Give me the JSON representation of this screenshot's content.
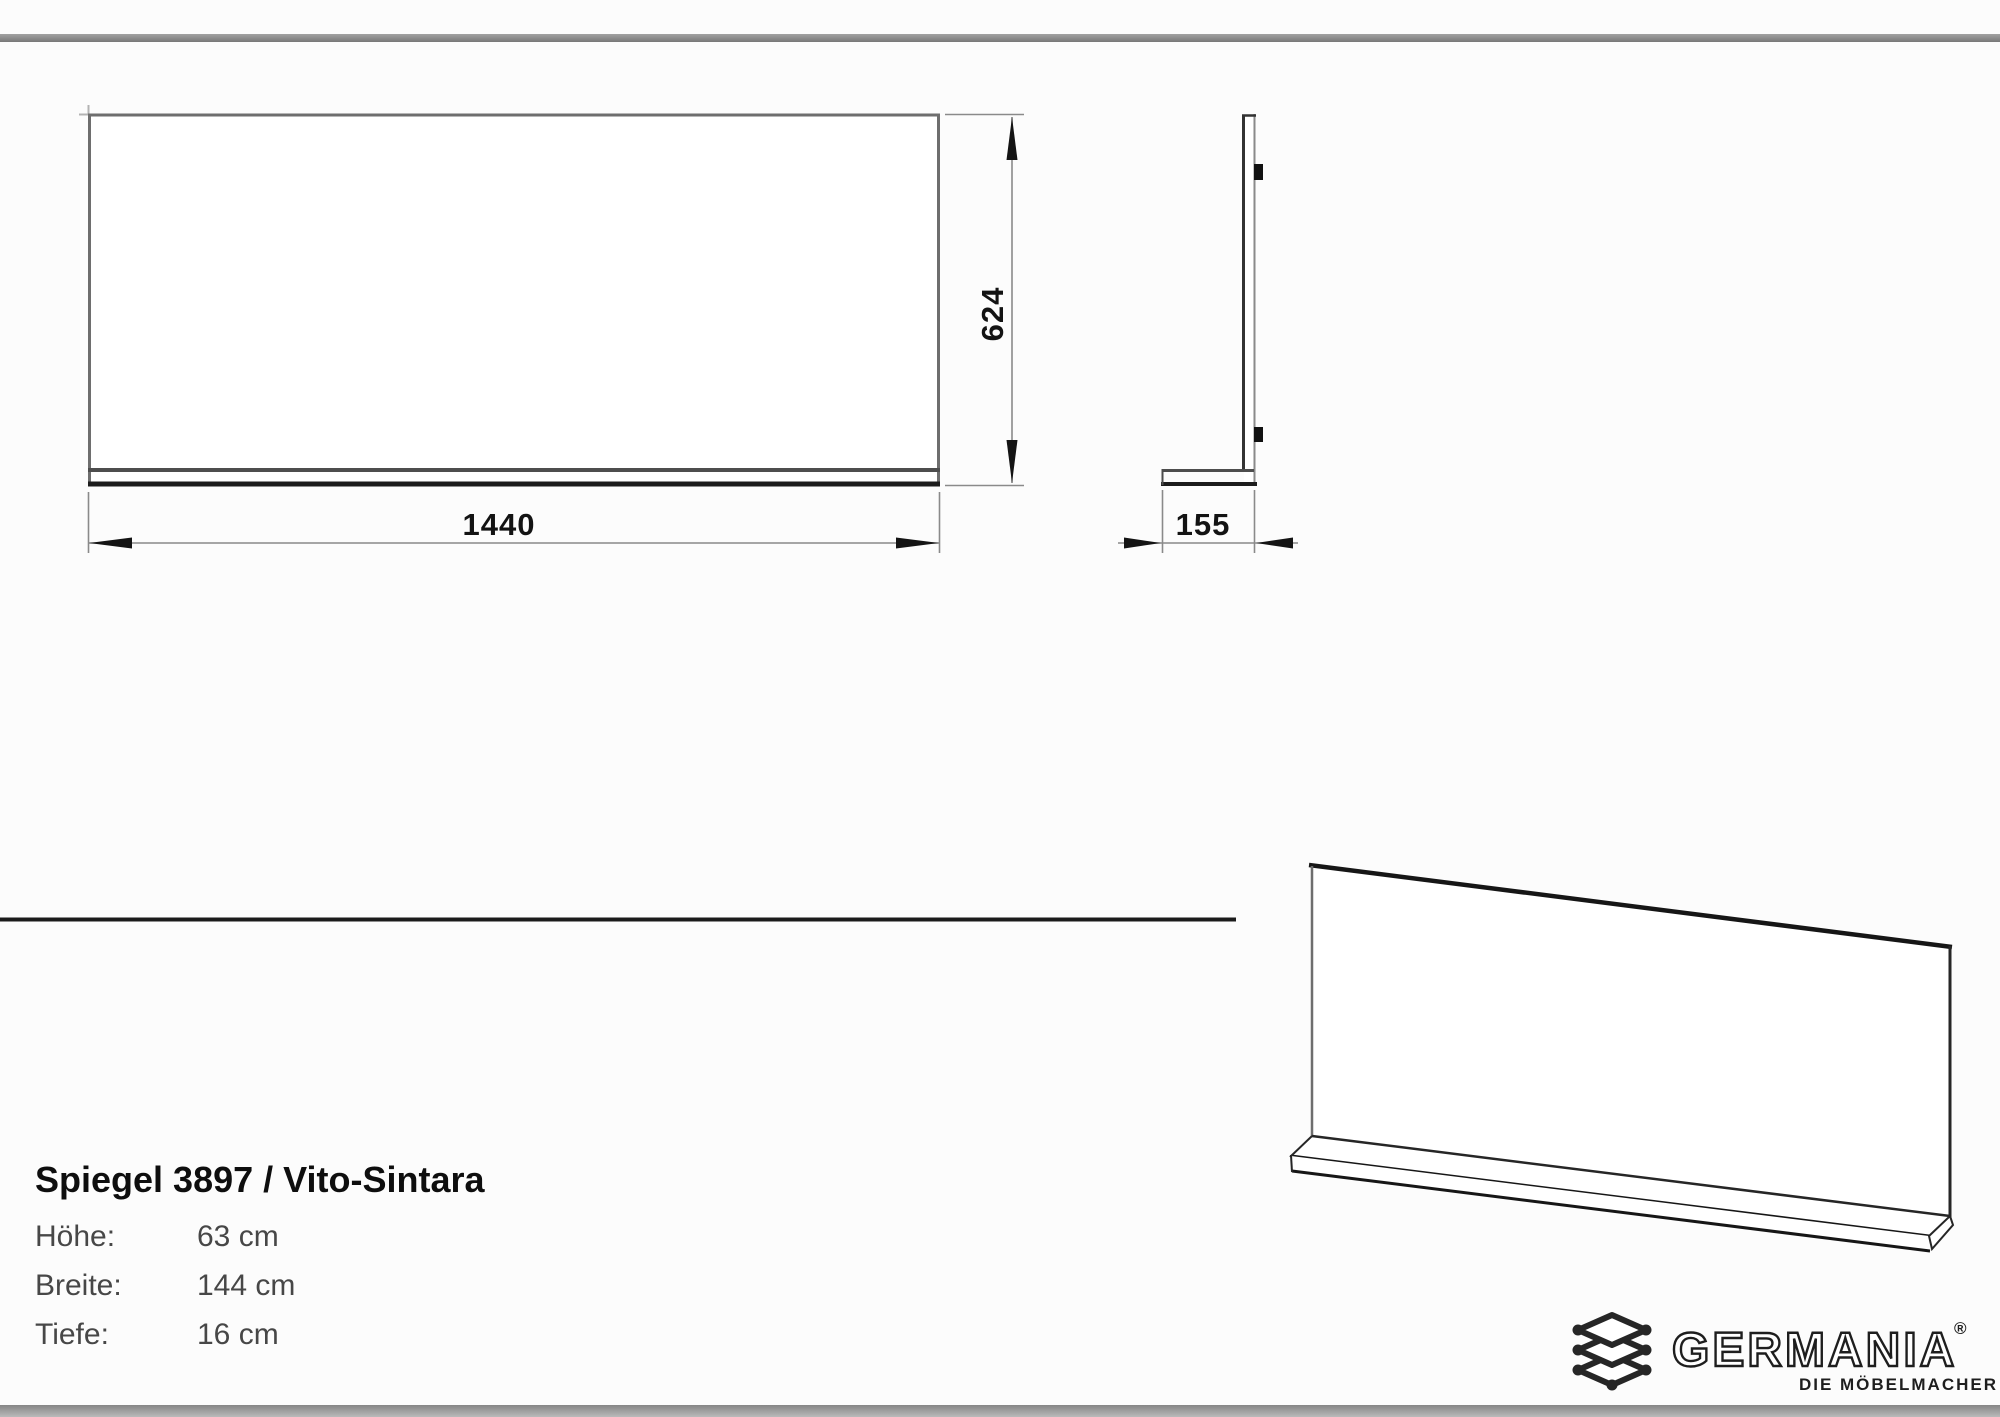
{
  "page": {
    "background": "#fcfcfc"
  },
  "bars": {
    "top_color": "#8c8c8c",
    "bottom_color": "#a8a8a8"
  },
  "colors": {
    "line_dark": "#1a1a1a",
    "line_gray": "#6e6e6e",
    "dim_line": "#8a8a8a"
  },
  "views": {
    "front": "front-elevation-view",
    "side": "side-profile-view",
    "perspective": "perspective-view"
  },
  "dimensions": {
    "width_mm": "1440",
    "height_mm": "624",
    "depth_mm": "155"
  },
  "specs": {
    "title": "Spiegel 3897 / Vito-Sintara",
    "rows": [
      {
        "label": "Höhe:",
        "value": "63 cm"
      },
      {
        "label": "Breite:",
        "value": "144 cm"
      },
      {
        "label": "Tiefe:",
        "value": "16 cm"
      }
    ]
  },
  "logo": {
    "brand": "GERMANIA",
    "registered": "®",
    "tagline": "DIE MÖBELMACHER"
  }
}
